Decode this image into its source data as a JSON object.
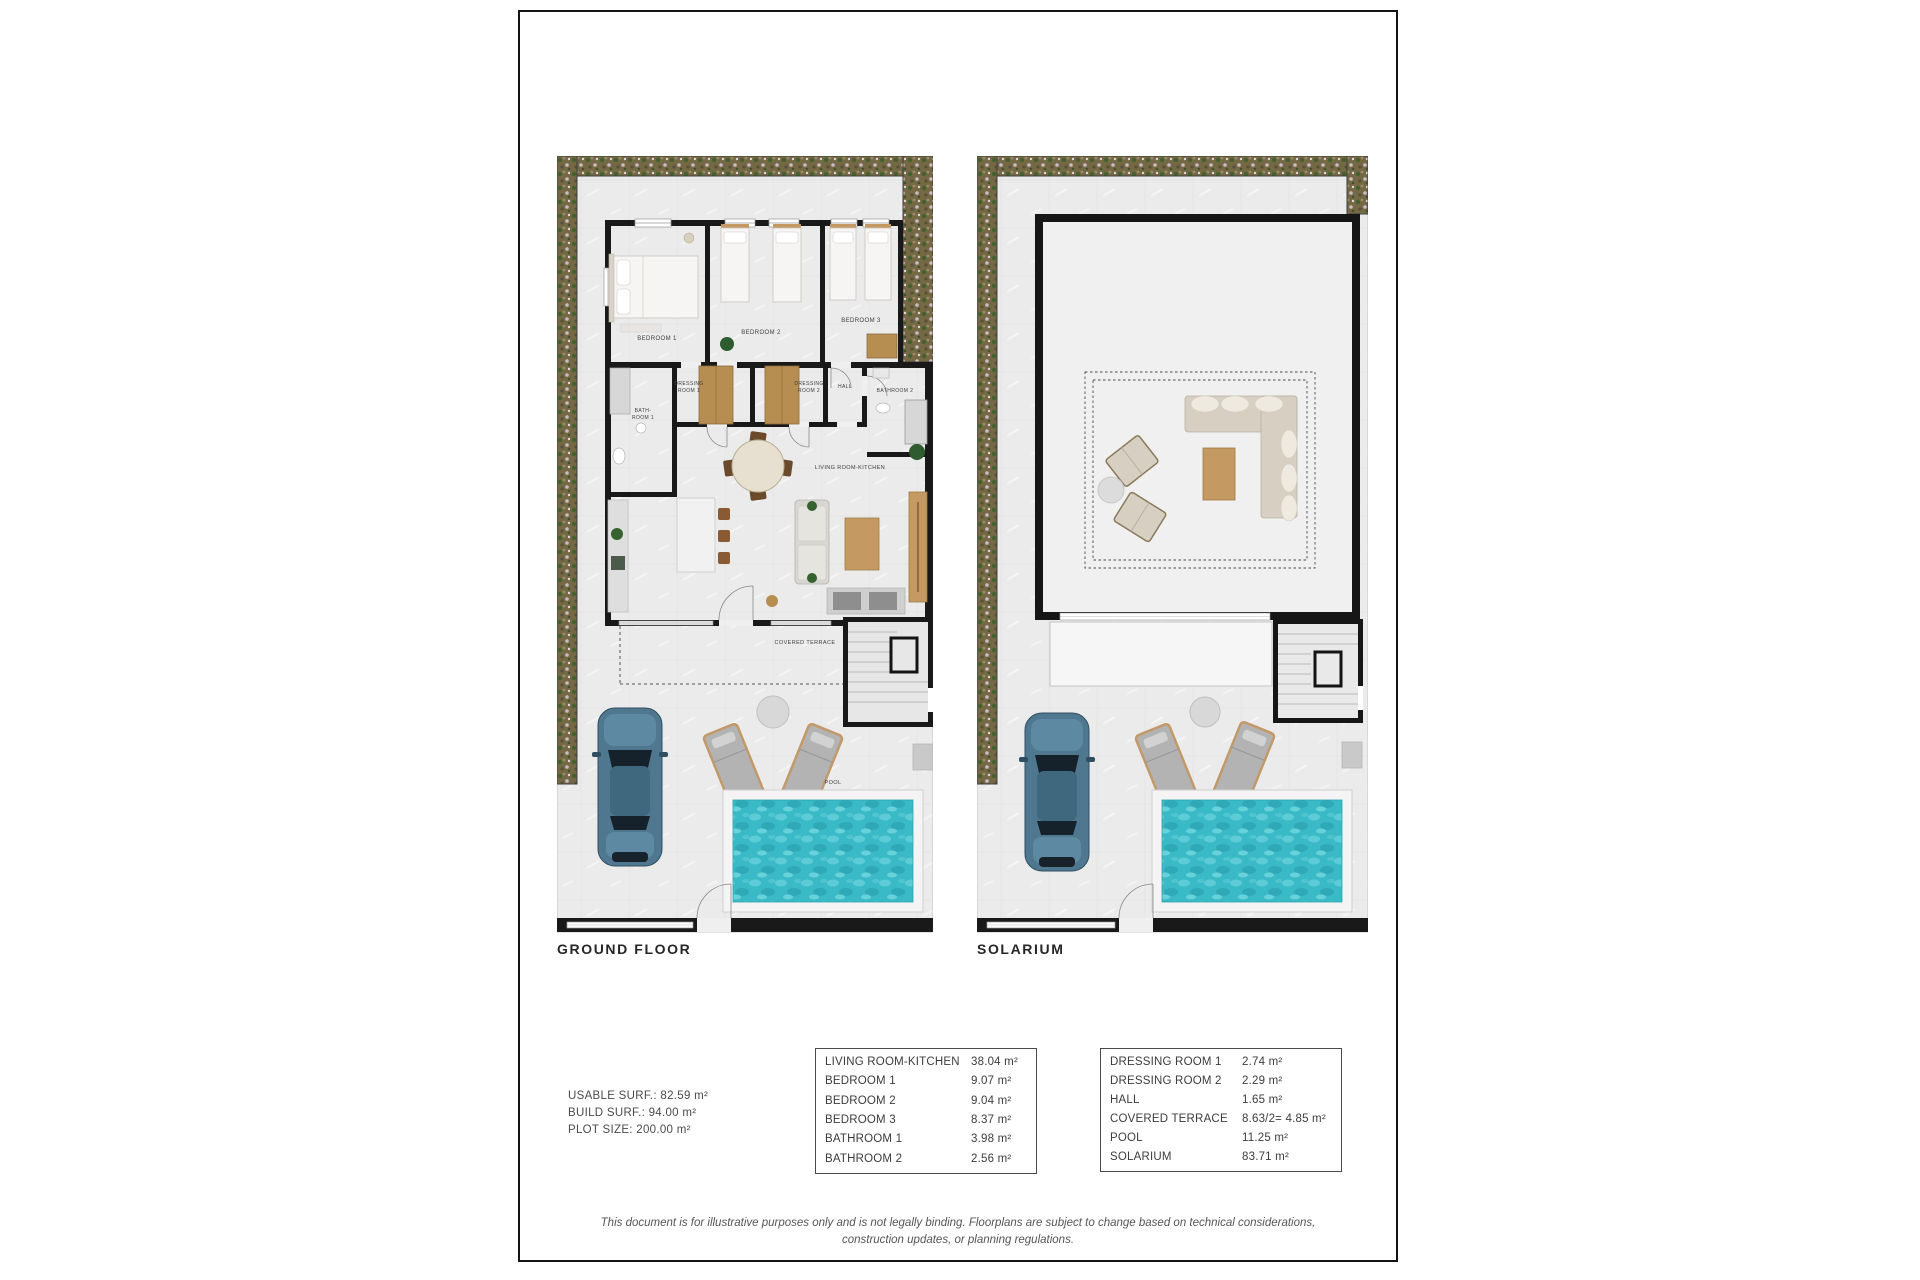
{
  "plans": {
    "ground_floor": {
      "caption": "GROUND FLOOR",
      "labels": {
        "bedroom_1": "BEDROOM 1",
        "bedroom_2": "BEDROOM 2",
        "bedroom_3": "BEDROOM 3",
        "dressing_room_1": [
          "DRESSING",
          "ROOM 1"
        ],
        "dressing_room_2": [
          "DRESSING",
          "ROOM 2"
        ],
        "hall": "HALL",
        "bathroom_1": [
          "BATH-",
          "ROOM 1"
        ],
        "bathroom_2": "BATHROOM 2",
        "living_room_kitchen": "LIVING ROOM-KITCHEN",
        "covered_terrace": "COVERED TERRACE",
        "pool": "POOL"
      }
    },
    "solarium": {
      "caption": "SOLARIUM"
    }
  },
  "summary": {
    "usable_surface": "USABLE SURF.: 82.59 m²",
    "build_surface": "BUILD SURF.: 94.00 m²",
    "plot_size": "PLOT SIZE: 200.00 m²"
  },
  "area_tables": {
    "left": {
      "rows": [
        {
          "label": "LIVING ROOM-KITCHEN",
          "value": "38.04 m²"
        },
        {
          "label": "BEDROOM 1",
          "value": "9.07 m²"
        },
        {
          "label": "BEDROOM 2",
          "value": "9.04 m²"
        },
        {
          "label": "BEDROOM 3",
          "value": "8.37 m²"
        },
        {
          "label": "BATHROOM 1",
          "value": "3.98 m²"
        },
        {
          "label": "BATHROOM 2",
          "value": "2.56 m²"
        }
      ]
    },
    "right": {
      "rows": [
        {
          "label": "DRESSING ROOM 1",
          "value": "2.74 m²"
        },
        {
          "label": "DRESSING ROOM 2",
          "value": "2.29 m²"
        },
        {
          "label": "HALL",
          "value": "1.65 m²"
        },
        {
          "label": "COVERED TERRACE",
          "value": "8.63/2= 4.85 m²"
        },
        {
          "label": "POOL",
          "value": "11.25 m²"
        },
        {
          "label": "SOLARIUM",
          "value": "83.71 m²"
        }
      ]
    }
  },
  "disclaimer": {
    "lines": [
      "This document is for illustrative purposes only and is not legally binding. Floorplans are subject to change based on technical considerations,",
      "construction updates, or planning regulations."
    ]
  },
  "colors": {
    "wall": "#191919",
    "floor": "#ebebeb",
    "garden": "#756845",
    "pool_water": "#3ab9c6",
    "wood": "#c49a62",
    "car_body": "#4f7890"
  }
}
